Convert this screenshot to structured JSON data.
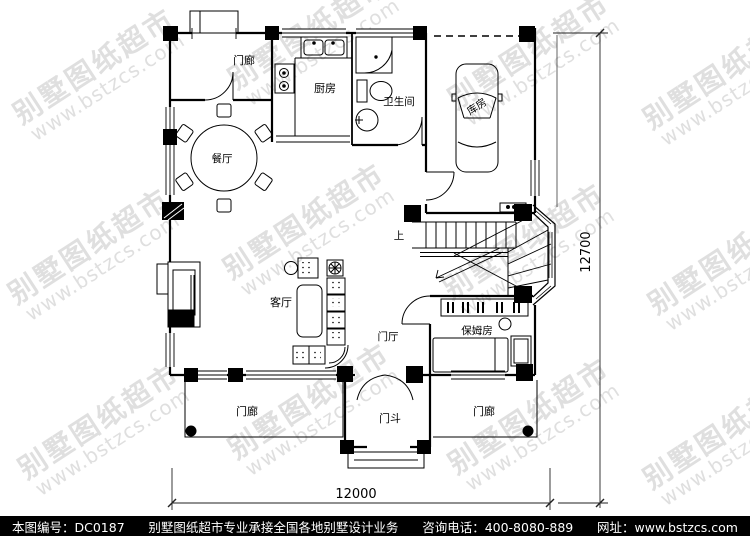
{
  "watermark": {
    "line1": "别墅图纸超市",
    "line2": "www.bstzcs.com"
  },
  "plan": {
    "labels": {
      "porch_top": "门廊",
      "kitchen": "厨房",
      "bathroom": "卫生间",
      "garage": "库房",
      "dining": "餐厅",
      "living": "客厅",
      "foyer": "门厅",
      "nanny_room": "保姆房",
      "vestibule": "门斗",
      "porch_left": "门廊",
      "porch_right": "门廊",
      "stairs_up": "上"
    },
    "dimensions": {
      "bottom": "12000",
      "right": "12700"
    },
    "colors": {
      "line": "#000000",
      "background": "#ffffff"
    }
  },
  "footer": {
    "drawing_no": "本图编号：DC0187",
    "service": "别墅图纸超市专业承接全国各地别墅设计业务",
    "phone": "咨询电话：400-8080-889",
    "website": "网址：www.bstzcs.com",
    "bg": "#000000",
    "fg": "#ffffff"
  }
}
